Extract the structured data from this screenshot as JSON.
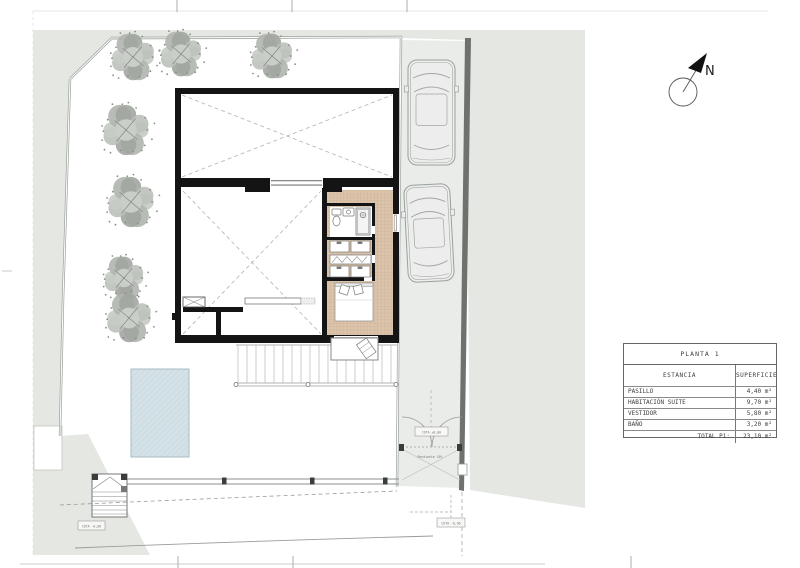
{
  "sheet": {
    "north_label": "N"
  },
  "areas_table": {
    "title": "PLANTA 1",
    "columns": {
      "room": "ESTANCIA",
      "area": "SUPERFICIE"
    },
    "rows": [
      {
        "room": "PASILLO",
        "area": "4,40 m²"
      },
      {
        "room": "HABITACIÓN SUITE",
        "area": "9,70 m²"
      },
      {
        "room": "VESTIDOR",
        "area": "5,80 m²"
      },
      {
        "room": "BAÑO",
        "area": "3,20 m²"
      }
    ],
    "total": {
      "label": "TOTAL P1:",
      "value": "23,10 m²"
    }
  },
  "plan_labels": {
    "gate_tag": "COTA ±0,00",
    "ramp_note": "Pendiente 16%",
    "stairs_tag": "COTA -0,60",
    "ground_tag": "COTA -0,90"
  },
  "site": {
    "trees": [
      {
        "x": 133,
        "y": 57,
        "r": 25
      },
      {
        "x": 181,
        "y": 54,
        "r": 24
      },
      {
        "x": 272,
        "y": 56,
        "r": 24
      },
      {
        "x": 126,
        "y": 130,
        "r": 27
      },
      {
        "x": 131,
        "y": 202,
        "r": 27
      },
      {
        "x": 124,
        "y": 278,
        "r": 23
      },
      {
        "x": 129,
        "y": 318,
        "r": 26
      }
    ],
    "cars": [
      {
        "x": 431.5,
        "y": 112.5,
        "w": 47,
        "h": 105,
        "rot": 0
      },
      {
        "x": 429,
        "y": 233,
        "w": 46,
        "h": 97,
        "rot": -3
      }
    ],
    "fence_posts": [
      222,
      310,
      383
    ],
    "step_rail_knobs": [
      236,
      308,
      396
    ]
  },
  "colors": {
    "terrain": "#e4e7e2",
    "driveway": "#eaecea",
    "boundary_wall": "#6e716e",
    "house_wall": "#141414",
    "tile_floor": "#dbc4ab",
    "pool": "#d4e2e7"
  }
}
